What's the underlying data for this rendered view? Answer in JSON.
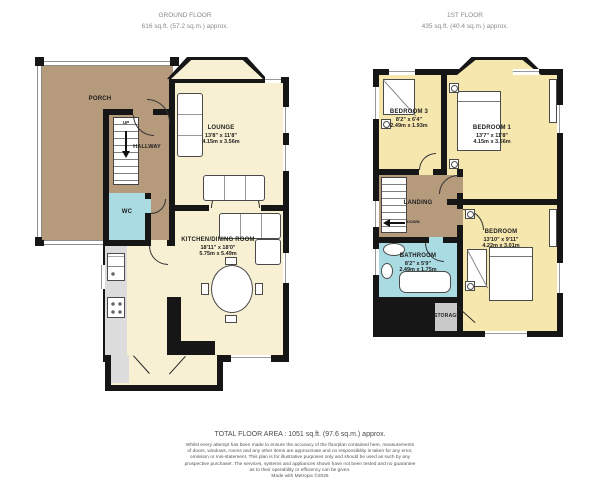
{
  "floors": {
    "ground": {
      "title": "GROUND FLOOR",
      "area": "616 sq.ft. (57.2 sq.m.) approx.",
      "rooms": {
        "porch": {
          "label": "PORCH"
        },
        "hallway": {
          "label": "HALLWAY"
        },
        "wc": {
          "label": "WC"
        },
        "lounge": {
          "label": "LOUNGE",
          "imperial": "13'8\" x 11'8\"",
          "metric": "4.15m x 3.56m"
        },
        "kitchen": {
          "label": "KITCHEN/DINING ROOM",
          "imperial": "18'11\" x 18'0\"",
          "metric": "5.75m x 5.49m"
        }
      },
      "stairs": {
        "direction": "UP"
      }
    },
    "first": {
      "title": "1ST FLOOR",
      "area": "435 sq.ft. (40.4 sq.m.) approx.",
      "rooms": {
        "bedroom1": {
          "label": "BEDROOM 1",
          "imperial": "13'7\" x 11'8\"",
          "metric": "4.15m x 3.56m"
        },
        "bedroom2": {
          "label": "BEDROOM",
          "imperial": "13'10\" x 9'11\"",
          "metric": "4.22m x 3.01m"
        },
        "bedroom3": {
          "label": "BEDROOM 3",
          "imperial": "8'2\" x 6'4\"",
          "metric": "2.49m x 1.93m"
        },
        "landing": {
          "label": "LANDING"
        },
        "bathroom": {
          "label": "BATHROOM",
          "imperial": "8'2\" x 5'9\"",
          "metric": "2.49m x 1.75m"
        },
        "storage": {
          "label": "STORAGE"
        }
      },
      "stairs": {
        "direction": "DOWN"
      }
    }
  },
  "footer": {
    "total_area": "TOTAL FLOOR AREA : 1051 sq.ft. (97.6 sq.m.) approx.",
    "disclaimer_lines": [
      "Whilst every attempt has been made to ensure the accuracy of the floorplan contained here, measurements",
      "of doors, windows, rooms and any other items are approximate and no responsibility is taken for any error,",
      "omission or mis-statement. This plan is for illustrative purposes only and should be used as such by any",
      "prospective purchaser. The services, systems and appliances shown have not been tested and no guarantee",
      "as to their operability or efficiency can be given.",
      "Made with Metropix ©2026"
    ]
  },
  "colors": {
    "wall": "#161616",
    "ground_room": "#f8f0d2",
    "first_room": "#f6e7ae",
    "circulation_brown": "#b59a7c",
    "wet_room_blue": "#aadbe2",
    "storage_gray": "#c9c9c9",
    "counter_gray": "#dcdcdc",
    "header_text": "#8a8a8a"
  }
}
